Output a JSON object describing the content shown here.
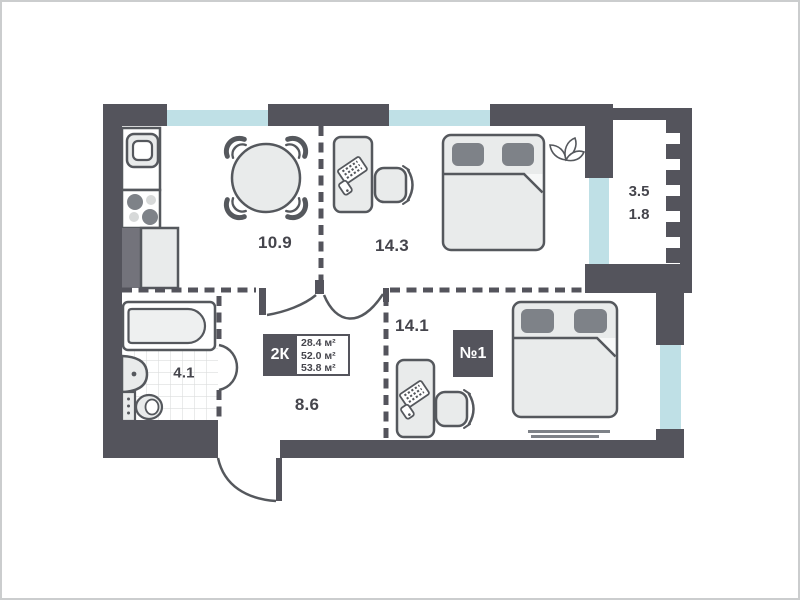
{
  "plan": {
    "unit": {
      "type_label": "2К",
      "area_lines": [
        "28.4 м²",
        "52.0 м²",
        "53.8 м²"
      ],
      "number_badge": "№1"
    },
    "room_labels": {
      "kitchen_living": "10.9",
      "bedroom_top": "14.3",
      "bedroom_right": "14.1",
      "hallway": "8.6",
      "bathroom": "4.1",
      "balcony_full": "3.5",
      "balcony_reduced": "1.8"
    },
    "colors": {
      "wall": "#54545c",
      "window": "#bfe0e6",
      "furniture_fill": "#e9ebeb",
      "furniture_stroke": "#55585d",
      "accent_gray": "#7e8288",
      "shaft_gray": "#9b9ea0",
      "tile_line": "#dcdddd",
      "text": "#45454c",
      "page_bg": "#ffffff",
      "frame": "#cbcdce"
    },
    "icons": [
      "dining-table-icon",
      "dining-chair-icon",
      "kitchen-sink-icon",
      "stove-icon",
      "fridge-icon",
      "kitchen-cabinet-icon",
      "desk-icon",
      "office-chair-icon",
      "double-bed-icon",
      "plant-icon",
      "bathtub-icon",
      "washbasin-icon",
      "toilet-icon",
      "rug-icon",
      "door-swing-icon",
      "window-strip",
      "balcony-railing"
    ]
  }
}
